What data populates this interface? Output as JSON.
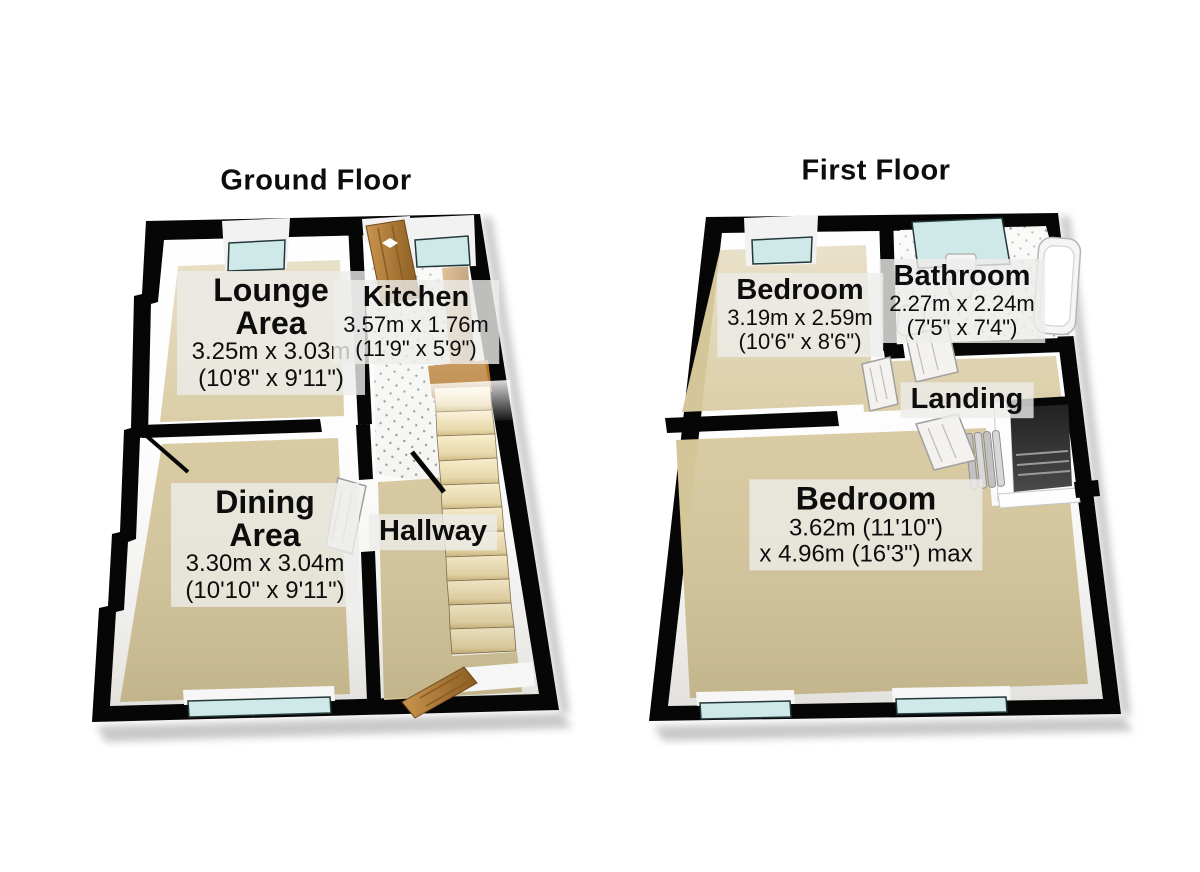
{
  "gf": {
    "title": "Ground Floor",
    "lounge": {
      "name": "Lounge Area",
      "dims": [
        "3.25m x 3.03m",
        "(10'8\" x 9'11\")"
      ]
    },
    "kitchen": {
      "name": "Kitchen",
      "dims": [
        "3.57m x 1.76m",
        "(11'9\" x 5'9\")"
      ]
    },
    "dining": {
      "name": "Dining Area",
      "dims": [
        "3.30m x 3.04m",
        "(10'10\" x 9'11\")"
      ]
    },
    "hallway": {
      "name": "Hallway"
    }
  },
  "ff": {
    "title": "First Floor",
    "bedroom_front": {
      "name": "Bedroom",
      "dims": [
        "3.19m x 2.59m",
        "(10'6\" x 8'6\")"
      ]
    },
    "bathroom": {
      "name": "Bathroom",
      "dims": [
        "2.27m x 2.24m",
        "(7'5\" x 7'4\")"
      ]
    },
    "landing": {
      "name": "Landing"
    },
    "bedroom_main": {
      "name": "Bedroom",
      "dims": [
        "3.62m (11'10\")",
        "x 4.96m (16'3\") max"
      ]
    }
  },
  "colors": {
    "wall": "#060606",
    "window_glass": "#cfe9e8",
    "carpet": "#d5c69a",
    "tile": "#f5f5f2",
    "wood": "#b2813d",
    "door_white": "#f4f2ee",
    "label_bg": "rgba(236,236,234,0.8)",
    "text": "#0d0d0d",
    "background": "#ffffff"
  }
}
